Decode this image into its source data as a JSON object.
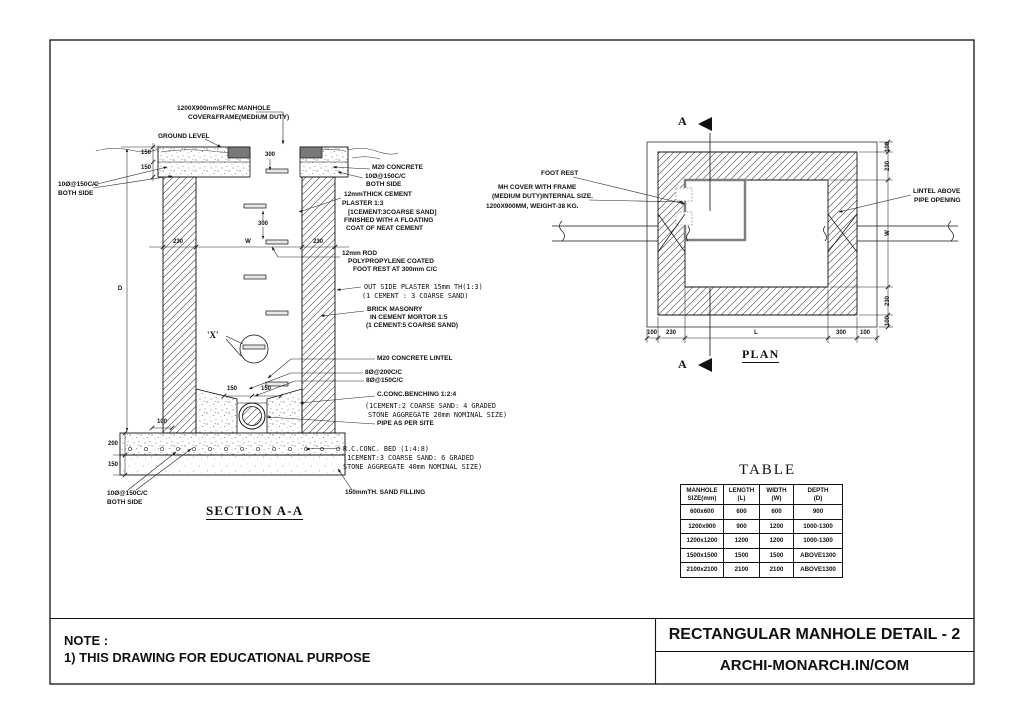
{
  "colors": {
    "line": "#111111",
    "cover_frame": "#787878",
    "paper": "#ffffff"
  },
  "section": {
    "title": "SECTION A-A",
    "cover1": "1200X900mmSFRC MANHOLE",
    "cover2": "COVER&FRAME(MEDIUM DUTY)",
    "ground": "GROUND LEVEL",
    "left_rebar1": "10Ø@150C/C",
    "left_rebar2": "BOTH SIDE",
    "m20": "M20 CONCRETE",
    "m20_rebar": "10Ø@150C/C",
    "m20_both": "BOTH SIDE",
    "plaster1": "12mmTHICK CEMENT",
    "plaster2": "PLASTER 1:3",
    "plaster3": "[1CEMENT:3COARSE SAND]",
    "plaster4": "FINISHED WITH A FLOATING",
    "plaster5": "COAT OF NEAT CEMENT",
    "rod1": "12mm ROD",
    "rod2": "POLYPROPYLENE COATED",
    "rod3": "FOOT REST AT 300mm C/C",
    "outplaster1": "OUT SIDE PLASTER 15mm TH(1:3)",
    "outplaster2": "(1 CEMENT : 3 COARSE SAND)",
    "brick1": "BRICK MASONRY",
    "brick2": "IN CEMENT MORTOR 1:5",
    "brick3": "(1 CEMENT:5 COARSE SAND)",
    "lintel": "M20 CONCRETE LINTEL",
    "bar200": "8Ø@200C/C",
    "bar150": "8Ø@150C/C",
    "bench1": "C.CONC.BENCHING 1:2:4",
    "bench2": "(1CEMENT:2 COARSE SAND: 4 GRADED",
    "bench3": "STONE AGGREGATE 20mm NOMINAL SIZE)",
    "pipe": "PIPE AS PER SITE",
    "bed1": "R.C.CONC. BED (1:4:8)",
    "bed2": "(1CEMENT:3 COARSE SAND: 6 GRADED",
    "bed3": "STONE AGGREGATE 40mm NOMINAL SIZE)",
    "sand": "150mmTH. SAND FILLING",
    "bot_rebar1": "10Ø@150C/C",
    "bot_rebar2": "BOTH SIDE",
    "x_label": "'X'",
    "dims": {
      "a": "150",
      "b": "150",
      "c": "230",
      "w": "W",
      "d": "230",
      "e": "300",
      "f": "300",
      "g": "D",
      "h": "150",
      "i": "150",
      "j": "100",
      "k": "200",
      "l": "150"
    }
  },
  "plan": {
    "title": "PLAN",
    "marker_top": "A",
    "marker_bottom": "A",
    "foot_rest": "FOOT REST",
    "mh1": "MH COVER WITH FRAME",
    "mh2": "(MEDIUM DUTY)INTERNAL SIZE.",
    "mh3": "1200X900MM, WEIGHT-38 KG.",
    "lintel1": "LINTEL ABOVE",
    "lintel2": "PIPE OPENING",
    "dims": {
      "r1": "100",
      "r2": "230",
      "r3": "W",
      "r4": "230",
      "r5": "100",
      "b1": "100",
      "b2": "230",
      "b3": "L",
      "b4": "300",
      "b5": "100"
    }
  },
  "table": {
    "title": "TABLE",
    "h": [
      [
        "MANHOLE",
        "SIZE(mm)"
      ],
      [
        "LENGTH",
        "(L)"
      ],
      [
        "WIDTH",
        "(W)"
      ],
      [
        "DEPTH",
        "(D)"
      ]
    ],
    "rows": [
      [
        "600x600",
        "600",
        "600",
        "900"
      ],
      [
        "1200x900",
        "900",
        "1200",
        "1000-1300"
      ],
      [
        "1200x1200",
        "1200",
        "1200",
        "1000-1300"
      ],
      [
        "1500x1500",
        "1500",
        "1500",
        "ABOVE1300"
      ],
      [
        "2100x2100",
        "2100",
        "2100",
        "ABOVE1300"
      ]
    ]
  },
  "footer": {
    "note_title": "NOTE :",
    "note1": "1) THIS DRAWING FOR EDUCATIONAL PURPOSE",
    "sheet_title": "RECTANGULAR MANHOLE DETAIL - 2",
    "site": "ARCHI-MONARCH.IN/COM"
  }
}
